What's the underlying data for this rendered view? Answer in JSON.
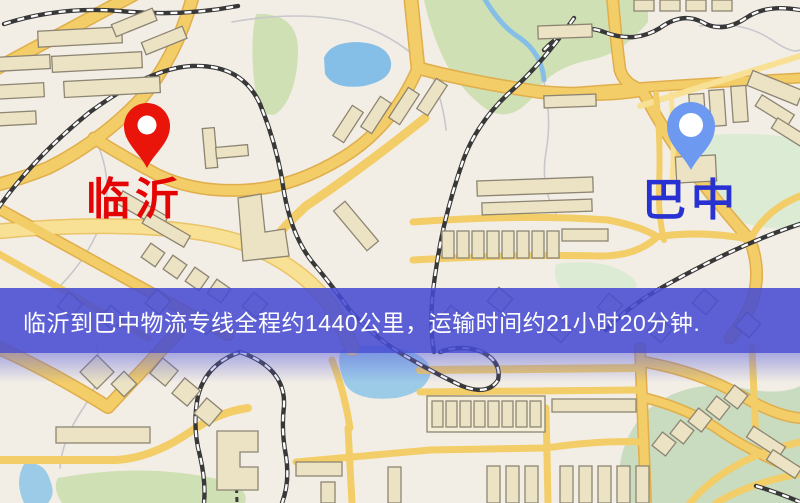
{
  "banner": {
    "text": "临沂到巴中物流专线全程约1440公里，运输时间约21小时20分钟."
  },
  "markers": [
    {
      "id": "origin",
      "label": "临沂",
      "pin_color": "#e9140a",
      "label_color": "#e40404"
    },
    {
      "id": "destination",
      "label": "巴中",
      "pin_color": "#6d9af0",
      "label_color": "#2832d2"
    }
  ],
  "theme": {
    "map-bg": "#f3eee5",
    "road": "#f2cd68",
    "road-edge": "#e0ae4c",
    "road-pale": "#f8e094",
    "road-pale-edge": "#eac468",
    "bld": "#ece3c4",
    "bld-box": "#f4eed9",
    "bld-stroke": "#8d8573",
    "park": "#cfe0b4",
    "park-pale": "#dcebd3",
    "park-deep": "#c9dcc0",
    "water": "#85bfe8",
    "water-soft": "#9ccbe8",
    "rail": "#383838",
    "path-gray": "#c8c7cc",
    "banner-bg": "rgba(70,75,210,0.87)",
    "banner-text": "#ffffff"
  }
}
